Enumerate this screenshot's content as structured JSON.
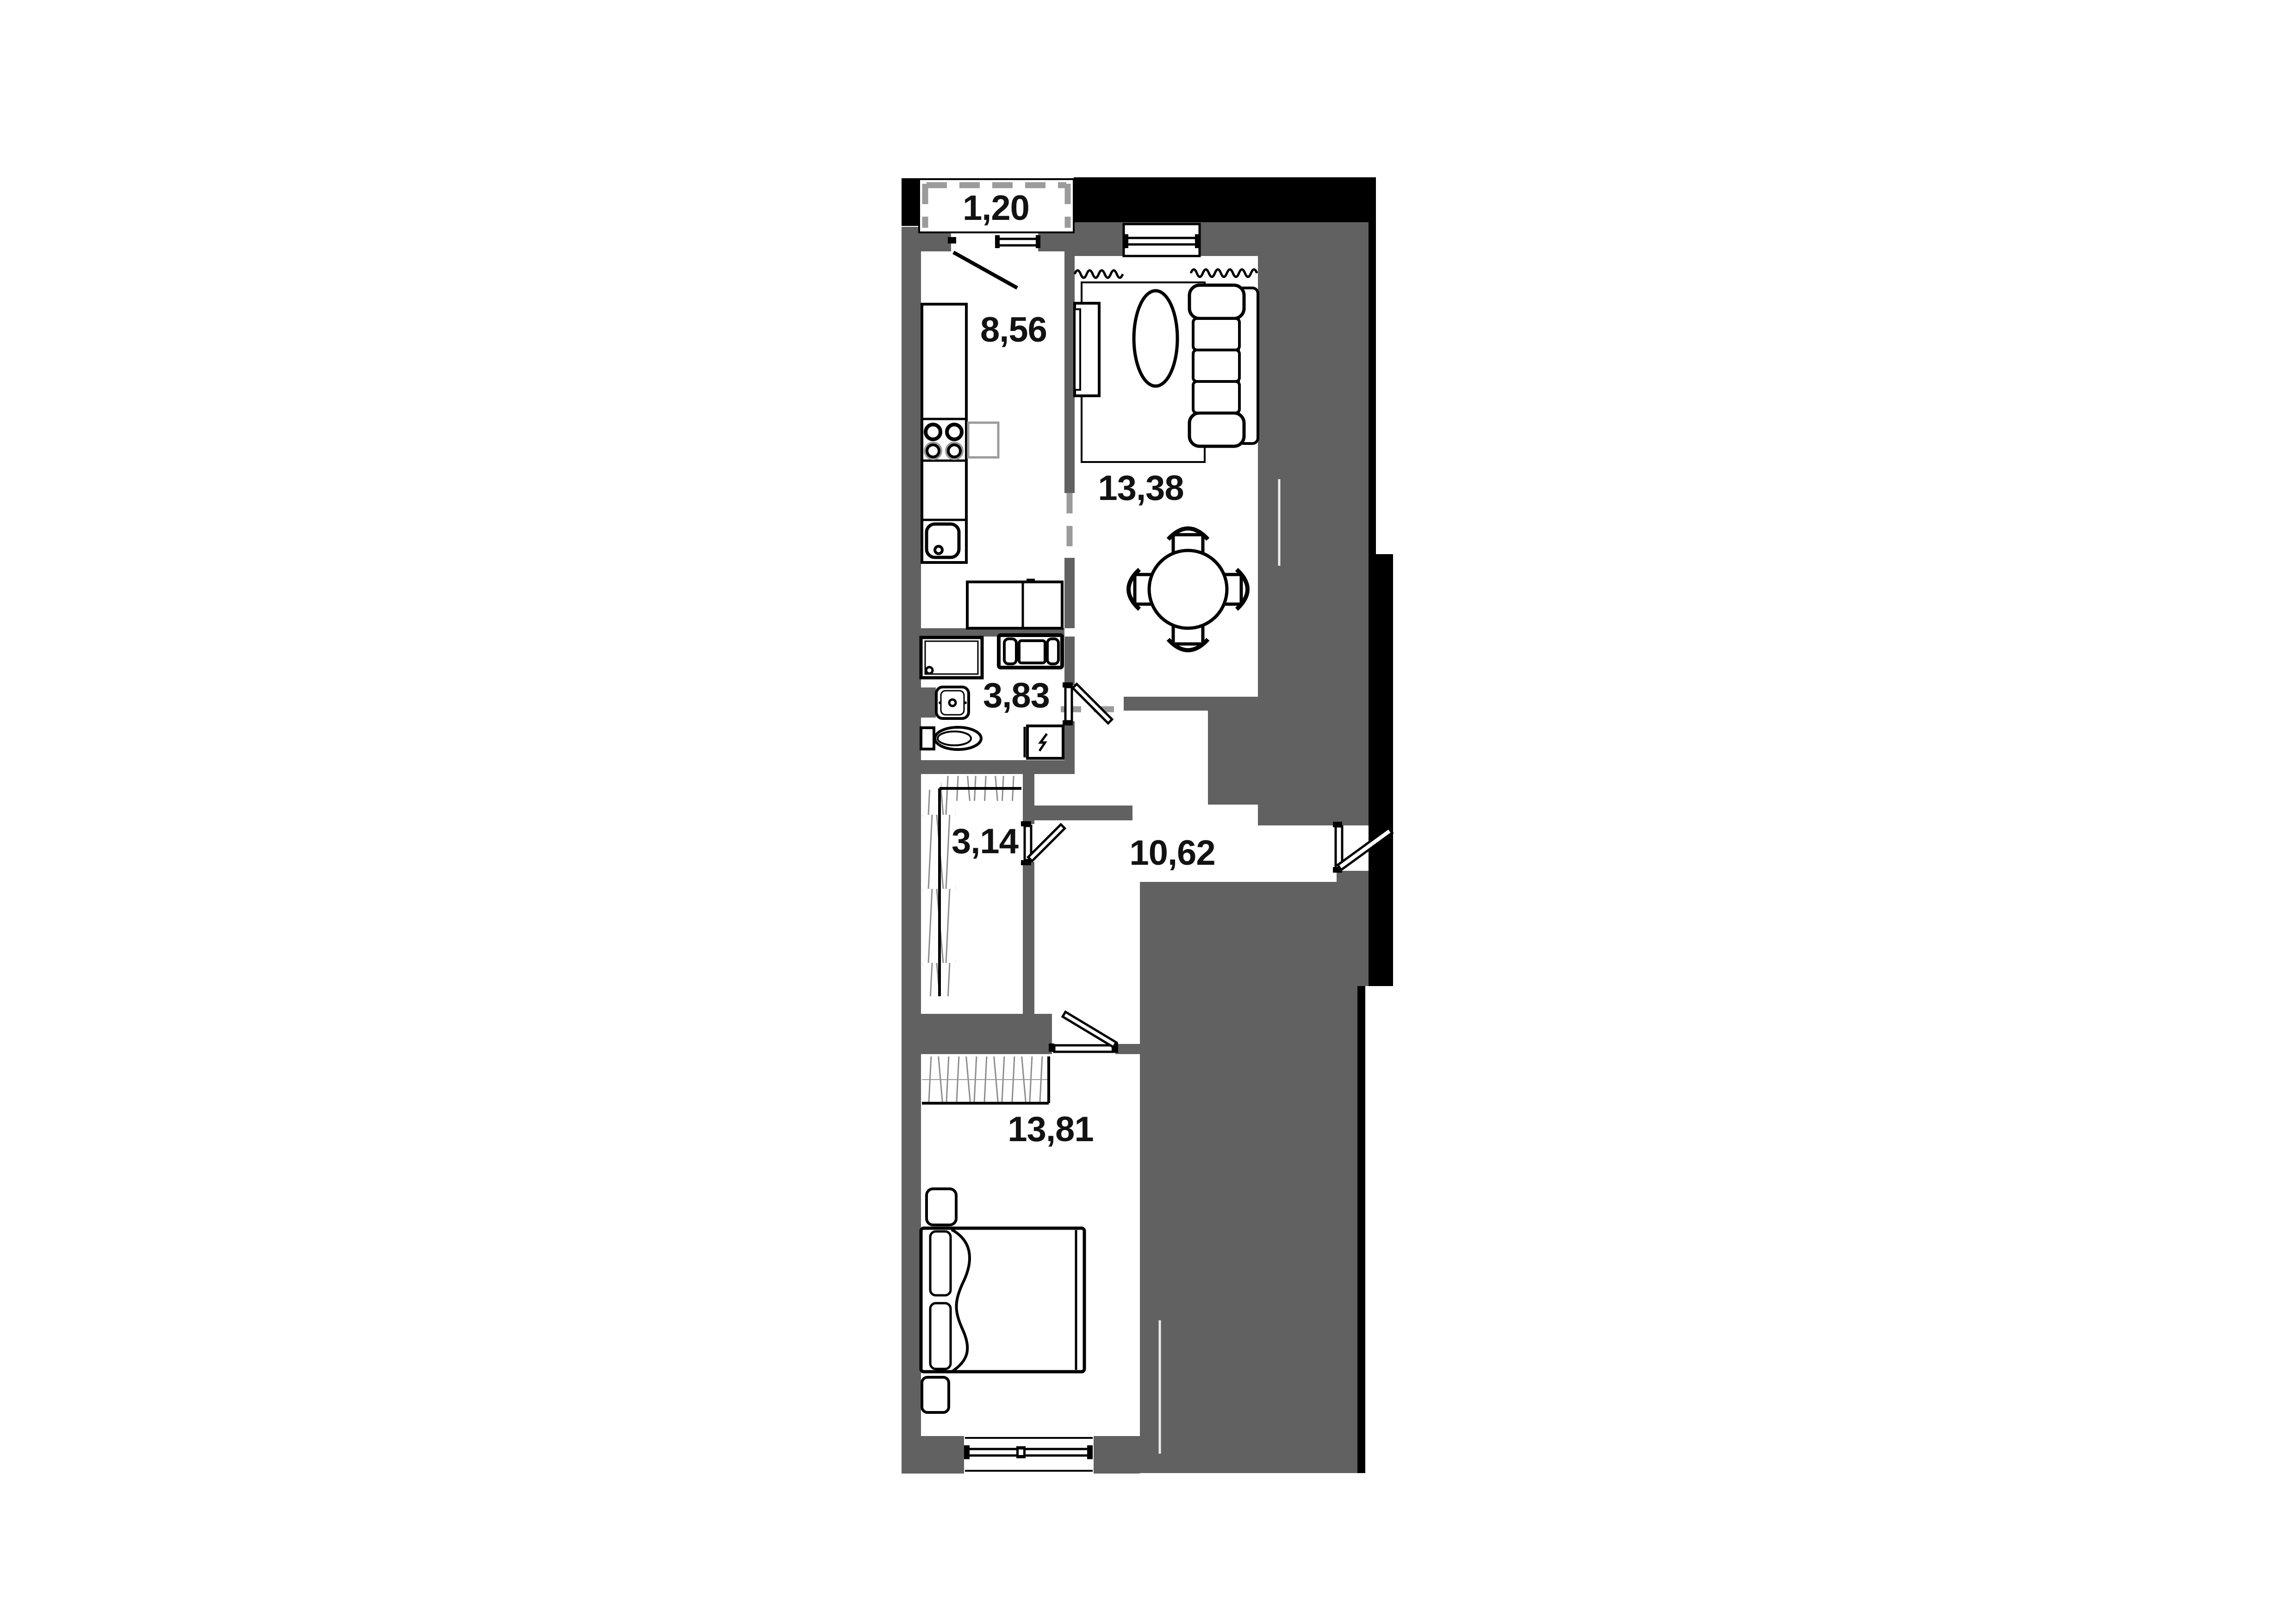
{
  "plan": {
    "type": "apartment-floor-plan",
    "rooms": {
      "balcony": {
        "name": "balcony",
        "area": "1,20"
      },
      "kitchen": {
        "name": "kitchen",
        "area": "8,56"
      },
      "living_room": {
        "name": "living-room",
        "area": "13,38"
      },
      "bathroom": {
        "name": "bathroom",
        "area": "3,83"
      },
      "wardrobe": {
        "name": "wardrobe",
        "area": "3,14"
      },
      "hallway": {
        "name": "hallway",
        "area": "10,62"
      },
      "bedroom": {
        "name": "bedroom",
        "area": "13,81"
      }
    },
    "fixtures": [
      "kitchen-counter",
      "stove-4-burners",
      "kitchen-sink",
      "kitchen-side-table",
      "tv-stand",
      "sofa",
      "coffee-table-oval",
      "rug",
      "dining-table-4-chairs",
      "shower-cabin",
      "bathroom-cabinet",
      "bathroom-sink",
      "toilet",
      "electric-boiler",
      "wardrobe-shelving",
      "built-in-closet",
      "double-bed",
      "pillows",
      "nightstand",
      "nightstand",
      "entrance-door",
      "bathroom-door",
      "wardrobe-door",
      "bedroom-door",
      "balcony-door",
      "kitchen-window",
      "living-room-window",
      "bedroom-window",
      "balcony-glazing",
      "radiator-squiggle"
    ],
    "colors": {
      "wall_gray": "#616161",
      "structure_black": "#000000",
      "floor_white": "#ffffff",
      "dashed_opening_gray": "#9b9b9b",
      "hatch_gray": "#8d8d8d",
      "label_text": "#121212"
    }
  }
}
